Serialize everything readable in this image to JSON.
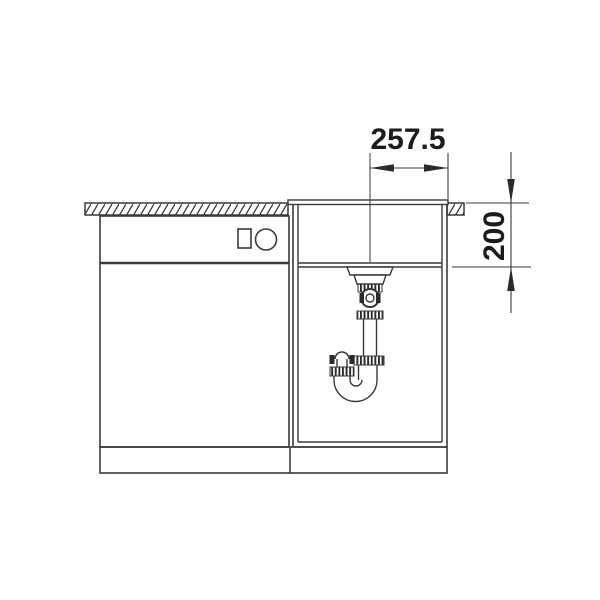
{
  "drawing": {
    "dimensions": {
      "horizontal": {
        "value": "257.5"
      },
      "vertical": {
        "value": "200"
      }
    },
    "colors": {
      "background": "#ffffff",
      "line": "#3a3a3a",
      "text": "#1c1c1c"
    }
  }
}
